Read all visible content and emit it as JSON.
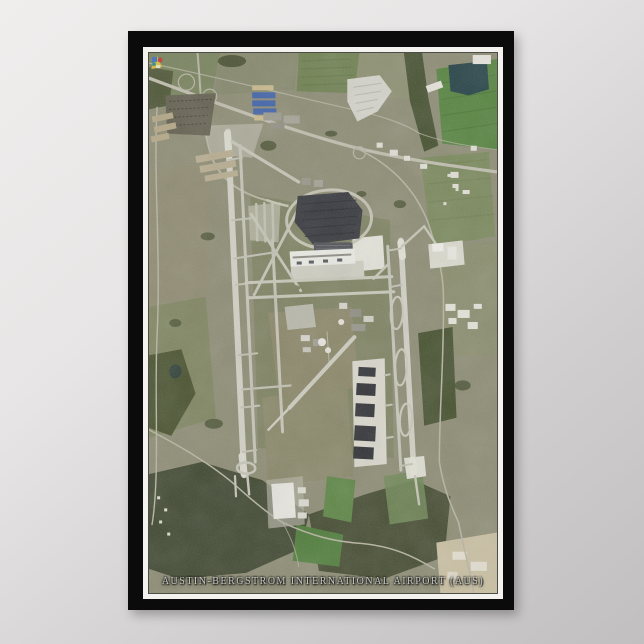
{
  "poster": {
    "caption": "AUSTIN-BERGSTROM INTERNATIONAL AIRPORT (AUS)"
  },
  "palette": {
    "wall": "#d9d7d7",
    "frame": "#0b0b0b",
    "mat": "#f4f2ee",
    "terrain": "#8d8c74",
    "woods": "#434b31",
    "bright_field": "#55833e",
    "pond_water": "#254247",
    "road": "#b7b5a3",
    "highway": "#c0beae",
    "runway": "#d2d1c5",
    "apron": "#e5e4da",
    "hangar_roof": "#303236",
    "terminal_parking": "#35373c"
  }
}
